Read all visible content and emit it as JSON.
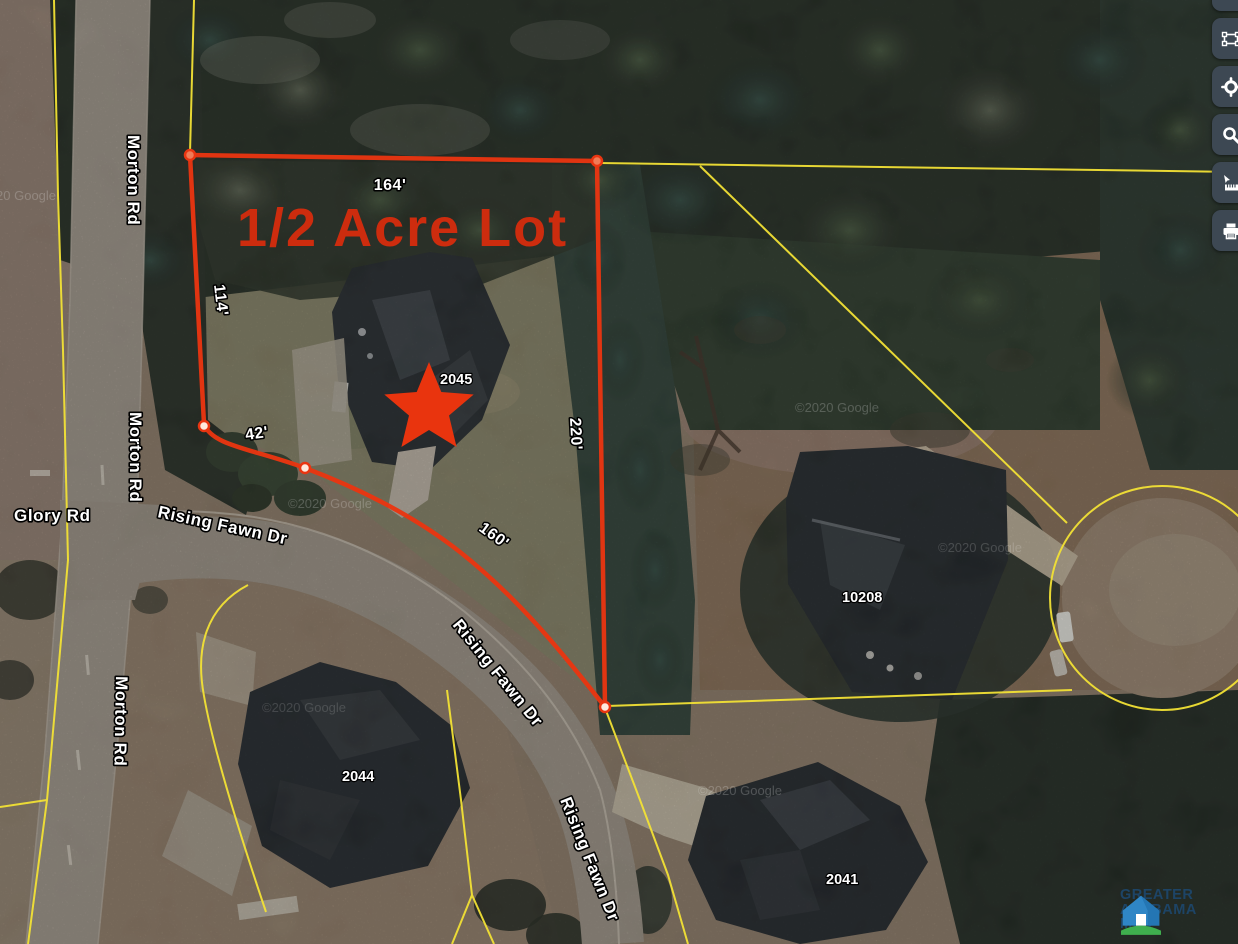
{
  "map": {
    "headline": "1/2 Acre Lot",
    "watermark": "©2020 Google",
    "dimensions": {
      "top": "164'",
      "left": "114'",
      "southwest": "42'",
      "right": "220'",
      "bottom": "160'"
    },
    "streets": {
      "morton": "Morton Rd",
      "glory": "Glory Rd",
      "rising": "Rising Fawn Dr"
    },
    "houses": {
      "subject": "2045",
      "east": "10208",
      "southwest": "2044",
      "south": "2041"
    },
    "colors": {
      "boundary_red": "#e93511",
      "parcel_yellow": "#f2e135",
      "headline_red": "#cd2c0e"
    }
  },
  "toolbar": {
    "buttons": [
      {
        "name": "collapsed-tool"
      },
      {
        "name": "select-extent"
      },
      {
        "name": "locate"
      },
      {
        "name": "search"
      },
      {
        "name": "measure"
      },
      {
        "name": "print"
      }
    ]
  },
  "logo": {
    "line1": "GREATER",
    "line2": "ALABAMA",
    "line3": "MLS"
  }
}
